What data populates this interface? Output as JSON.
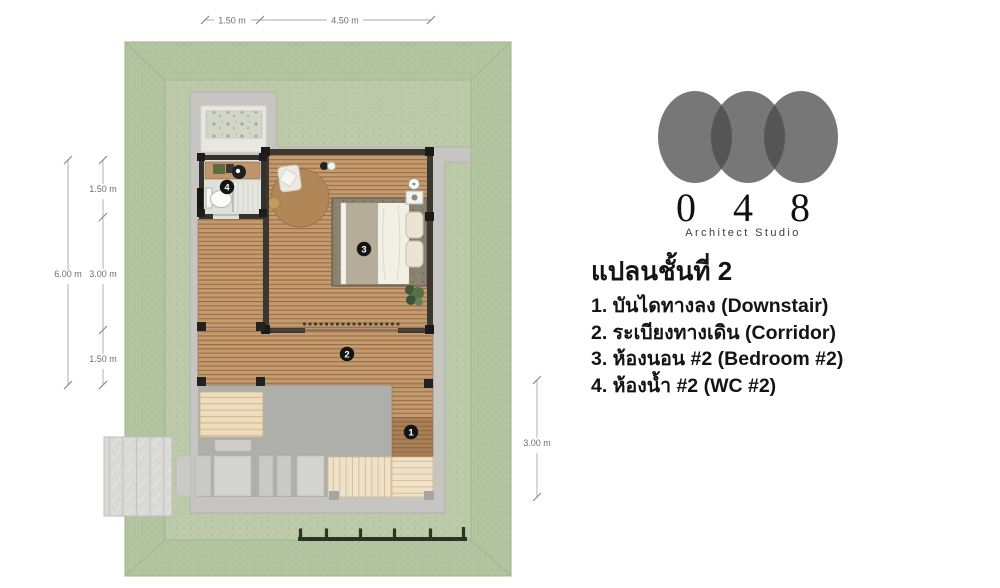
{
  "logo": {
    "digits": [
      "0",
      "4",
      "8"
    ],
    "subtitle": "Architect Studio"
  },
  "legend": {
    "title": "แปลนชั้นที่ 2",
    "items": [
      "1. บันไดทางลง (Downstair)",
      "2. ระเบียงทางเดิน (Corridor)",
      "3. ห้องนอน #2 (Bedroom #2)",
      "4. ห้องน้ำ #2 (WC #2)"
    ]
  },
  "plan": {
    "badges": {
      "downstair": "1",
      "corridor": "2",
      "bedroom": "3",
      "wc": "4"
    },
    "dimensions": {
      "top": [
        "1.50 m",
        "4.50 m"
      ],
      "left_overall": "6.00 m",
      "left_segments": [
        "1.50 m",
        "3.00 m",
        "1.50 m"
      ],
      "right": "3.00 m"
    },
    "colors": {
      "lawn_outer": "#b3c4a0",
      "lawn_inner": "#bccaa9",
      "lawn_line": "#a3b492",
      "pad": "#c6c5c2",
      "ground": "#aeaeab",
      "wall": "#3b3731",
      "fence": "#2b3322",
      "wc_floor": "#e0e0db",
      "bed_rug": "#8a8170",
      "round_rug": "#b18758"
    }
  }
}
